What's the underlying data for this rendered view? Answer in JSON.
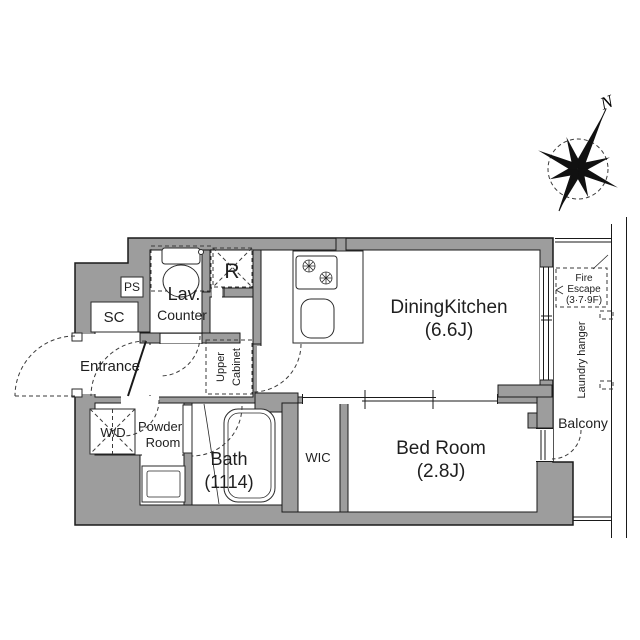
{
  "colors": {
    "wall_fill": "#9d9d9d",
    "outline": "#1a1a1a",
    "background": "#ffffff",
    "text": "#1f1f1f"
  },
  "compass": {
    "north": "N"
  },
  "rooms": {
    "dining_kitchen": {
      "name": "DiningKitchen",
      "size": "(6.6J)"
    },
    "bed_room": {
      "name": "Bed Room",
      "size": "(2.8J)"
    },
    "bath": {
      "name": "Bath",
      "size": "(1114)"
    },
    "wic": {
      "name": "WIC"
    },
    "entrance": {
      "name": "Entrance"
    },
    "powder_room": {
      "line1": "Powder",
      "line2": "Room"
    },
    "balcony": {
      "name": "Balcony"
    },
    "lavatory": {
      "name": "Lav.",
      "counter": "Counter"
    },
    "shoe_closet": {
      "name": "SC"
    },
    "pipe_space": {
      "name": "PS"
    },
    "refrigerator": {
      "name": "R"
    },
    "washer_dryer": {
      "name": "W/D"
    },
    "upper_cabinet": {
      "line1": "Upper",
      "line2": "Cabinet"
    },
    "fire_escape": {
      "line1": "Fire",
      "line2": "Escape",
      "line3": "(3·7·9F)"
    },
    "laundry_hanger": {
      "name": "Laundry hanger"
    }
  }
}
